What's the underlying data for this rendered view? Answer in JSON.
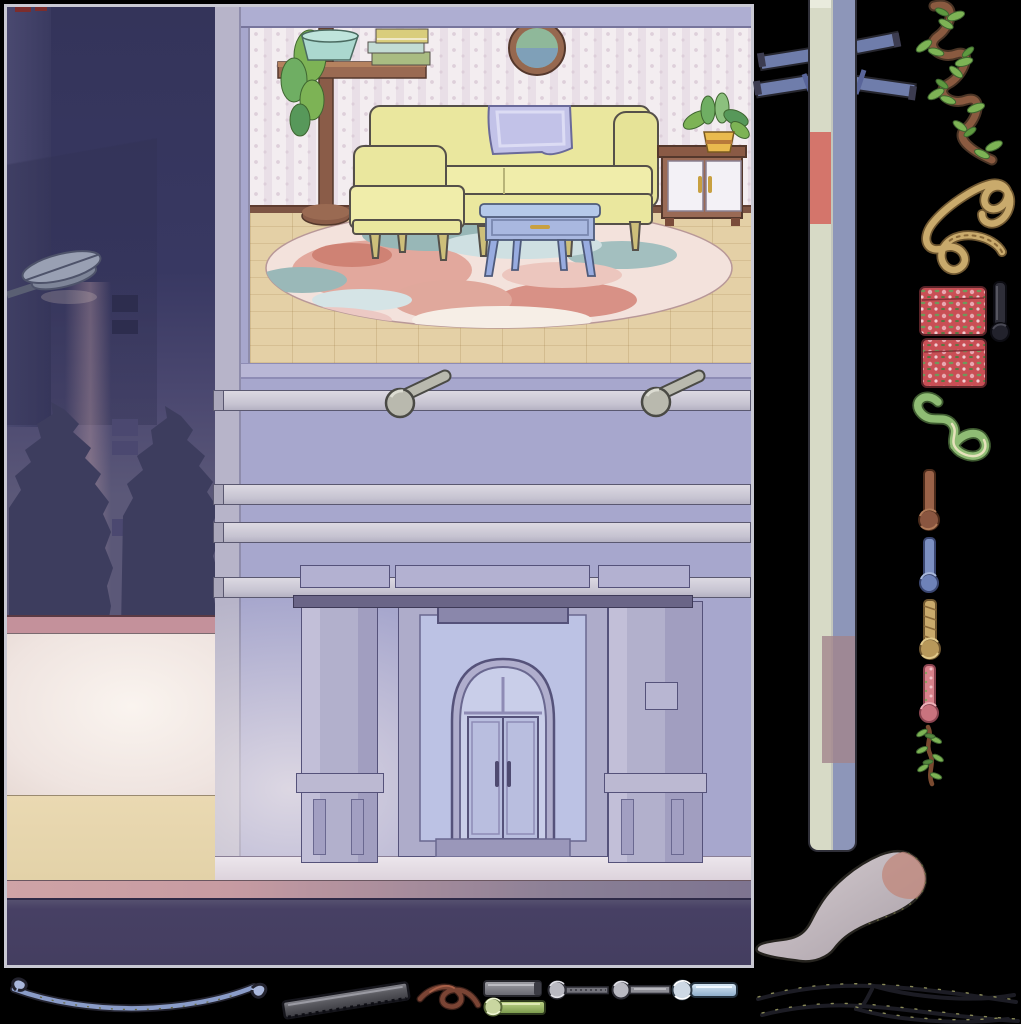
{
  "scene": {
    "description": "night street corner with lit shop entrance and upstairs living-room interior",
    "border_color": "#c9c9d3",
    "background": "#000000",
    "street": {
      "lamp": "street-lamp",
      "tree_count": 2,
      "window_count": 5
    },
    "facade": {
      "rail_count": 4,
      "peg_count": 2,
      "entrance": "arched double door",
      "plaque": "door-sign"
    },
    "interior": {
      "furniture": [
        "plant-stand",
        "hanging-plant",
        "book-stack",
        "wall-mirror",
        "sofa",
        "throw-blanket",
        "armchair",
        "coffee-table",
        "round-rug",
        "side-cabinet",
        "potted-plant"
      ],
      "book_count": 3
    }
  },
  "palette": {
    "night_building": "#35355a",
    "dusk_wall": "#5b5878",
    "tree": "#3d3d5e",
    "lamp_gray": "#99a0b3",
    "low_wall_pink": "#c4919b",
    "sidewalk": "#474064",
    "building_wall": "#a7a7cd",
    "corner_trim": "#b7b4c9",
    "rail": "#d6d3dc",
    "floor_trim": "#7d5443",
    "sofa_yellow": "#eae79e",
    "sofa_outline": "#55504a",
    "blanket_lavender": "#c2c2e8",
    "table_blue": "#b5c9ea",
    "table_body": "#a9b8e0",
    "rug_base": "#f3e2dc",
    "rug_salmon": "#de9e92",
    "rug_teal": "#98b7b7",
    "cabinet_brown": "#9a6a55",
    "cabinet_door": "#f3f1f6",
    "mirror_frame": "#96684f",
    "mirror_glass": "#8fb89a",
    "leaf_green": "#7db355",
    "leaf_dark": "#5e9940",
    "pot_teal": "#abd8cf",
    "pot_yellow": "#e9ba4e",
    "wood_brown": "#8a5c48",
    "peg_gray": "#b9b9ae",
    "pole_light": "#d7dac6",
    "pole_shade": "#8d96b9",
    "pole_red_patch": "#d4756b",
    "pole_mauve_patch": "#a3848c",
    "crossarm_blue": "#6f7dab",
    "vine_brown": "#8a5a40",
    "rope_tan": "#c9aa6c",
    "fabric_red": "#c94f55",
    "cord_black": "#2e2e38",
    "squiggle_green": "#8fbc74",
    "stick_brown": "#9a6248",
    "stick_blue": "#7d90c2",
    "fabric_pink": "#d9838c",
    "stocking_gray": "#c0b6ba",
    "stocking_toe": "#c08a7e",
    "wire_blue": "#8a9cc8",
    "pipe_dark": "#5a5a60",
    "pipe_gray": "#8e8e94",
    "pipe_green": "#a6c070",
    "pipe_blue": "#aecbe4",
    "leather_brown": "#7a4434",
    "twig_black": "#1c1c24"
  },
  "sprites": {
    "pole": {
      "name": "utility-pole",
      "crossarm_count": 4
    },
    "right_column": [
      {
        "name": "leafy-vine"
      },
      {
        "name": "rope-coil"
      },
      {
        "name": "floral-fabric-rolls",
        "count": 2
      },
      {
        "name": "black-cord-stick"
      },
      {
        "name": "green-cord"
      },
      {
        "name": "brown-knotted-stick"
      },
      {
        "name": "blue-knotted-stick"
      },
      {
        "name": "rope-knotted-stick"
      },
      {
        "name": "floral-knotted-stick"
      },
      {
        "name": "leafy-twig"
      }
    ],
    "bottom_row": [
      {
        "name": "sagging-wire"
      },
      {
        "name": "dark-metal-pipe"
      },
      {
        "name": "leather-twist"
      },
      {
        "name": "gray-pipe"
      },
      {
        "name": "green-wrapped-pipe"
      },
      {
        "name": "knotted-rod-1"
      },
      {
        "name": "knotted-rod-2"
      },
      {
        "name": "blue-wrapped-pipe"
      }
    ],
    "bottom_right": [
      {
        "name": "stocking"
      },
      {
        "name": "thorny-twigs"
      }
    ]
  }
}
